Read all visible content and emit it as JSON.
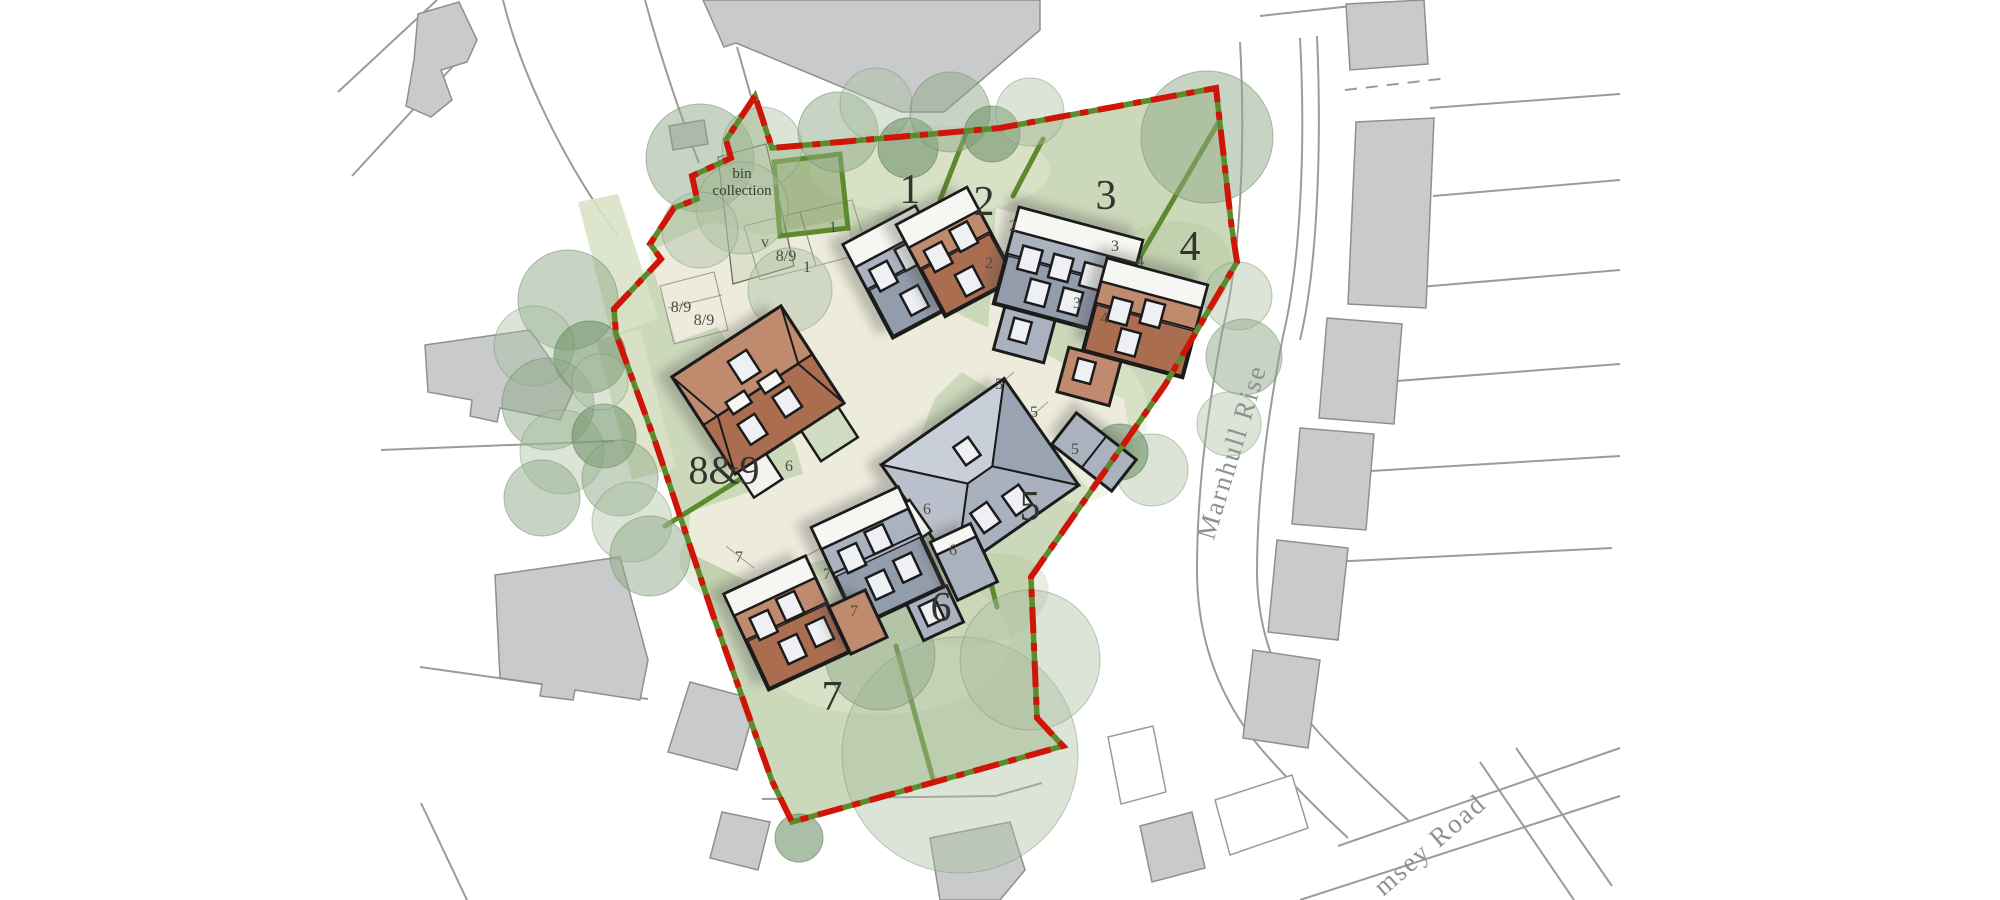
{
  "labels": {
    "bin_collection": "bin collection",
    "plots": [
      "1",
      "2",
      "3",
      "4",
      "5",
      "6",
      "7",
      "8&9"
    ],
    "parking": [
      "v",
      "8/9",
      "1",
      "1",
      "8/9",
      "8/9",
      "2",
      "2",
      "3",
      "4",
      "3",
      "4",
      "5",
      "5",
      "5",
      "6",
      "6",
      "6",
      "7",
      "7",
      "7"
    ],
    "roads": [
      "Marnhull Rise",
      "msey Road"
    ]
  },
  "colors": {
    "boundary_red": "#cf1408",
    "hedge_green": "#5d8a2d",
    "grass": "#ccd8ba",
    "grass_light": "#d9e2c6",
    "grass_dark": "#b4c79c",
    "tree_canopy": "#8fa988",
    "road_surface": "#edebdc",
    "house_gray": "#aab2bf",
    "house_gray_dark": "#939cab",
    "house_terracotta": "#c08a6e",
    "house_terracotta_dark": "#ab6d50",
    "roof_white": "#f6f6f2",
    "context_building": "#c9cacb",
    "context_line": "#9b9b9b",
    "outline": "#1b1b1b",
    "label_dark": "#33342f",
    "label_road": "#8f9191"
  }
}
